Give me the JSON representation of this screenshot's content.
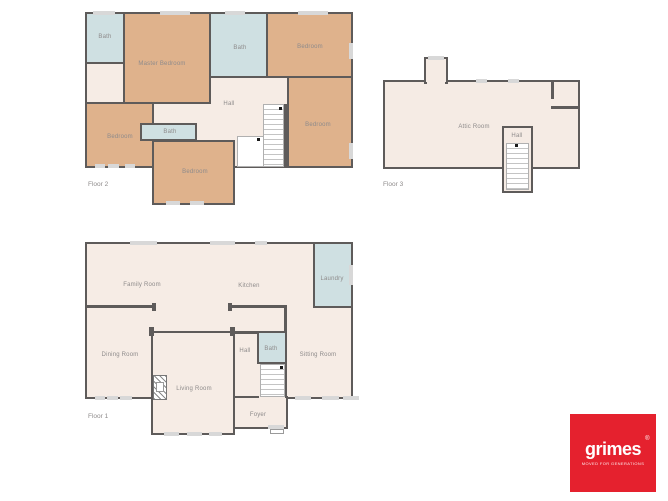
{
  "colors": {
    "wall": "#5e5b5a",
    "bedroom_fill": "#dfb28c",
    "bath_fill": "#cfe0e2",
    "hall_fill": "#f6ece5",
    "window_fill": "#d8d8d8",
    "label_text": "#8e8b8b",
    "logo_red": "#e5212e",
    "logo_text": "#ffffff"
  },
  "floor2": {
    "label": "Floor 2",
    "rooms": {
      "bath_top_left": "Bath",
      "master_bedroom": "Master Bedroom",
      "bath_top_center": "Bath",
      "bedroom_top_right": "Bedroom",
      "bedroom_right": "Bedroom",
      "bedroom_bottom_left": "Bedroom",
      "bath_small": "Bath",
      "bedroom_bottom": "Bedroom",
      "hall": "Hall"
    }
  },
  "floor3": {
    "label": "Floor 3",
    "rooms": {
      "attic_room": "Attic Room",
      "hall": "Hall"
    }
  },
  "floor1": {
    "label": "Floor 1",
    "rooms": {
      "family_room": "Family Room",
      "kitchen": "Kitchen",
      "laundry": "Laundry",
      "dining_room": "Dining Room",
      "living_room": "Living Room",
      "hall": "Hall",
      "bath": "Bath",
      "sitting_room": "Sitting Room",
      "foyer": "Foyer"
    }
  },
  "logo": {
    "brand": "grimes",
    "registered_mark": "®",
    "tagline": "MOVED FOR GENERATIONS"
  }
}
